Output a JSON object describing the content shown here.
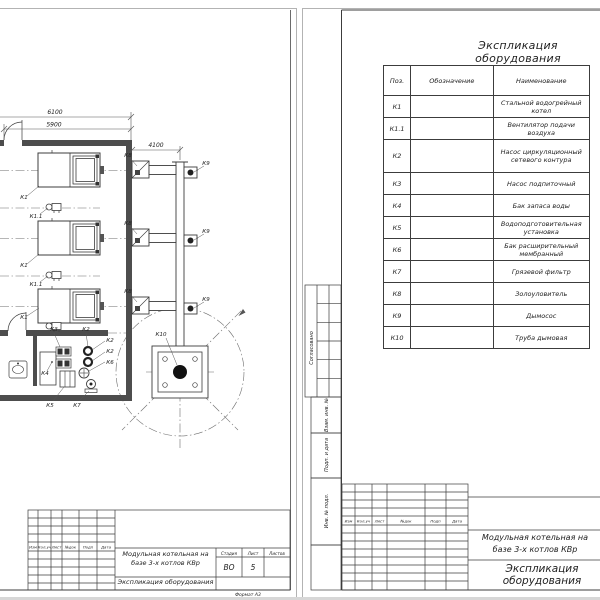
{
  "left_sheet": {
    "dimensions": {
      "top": "6100",
      "inner": "5900",
      "flue": "4100"
    },
    "callouts": {
      "k1": "К1",
      "k1_1": "К1.1",
      "k2": "К2",
      "k3": "К3",
      "k4": "К4",
      "k5": "К5",
      "k6": "К6",
      "k7": "К7",
      "k8": "К8",
      "k9": "К9",
      "k10": "К10"
    },
    "revision_header": [
      "Изм",
      "Кол.уч",
      "Лист",
      "№док",
      "Подп",
      "Дата"
    ],
    "title_block": {
      "project": "Модульная котельная на базе 3-х котлов КВр",
      "document": "Экспликация оборудования",
      "stage_label": "Стадия",
      "sheet_label": "Лист",
      "sheets_label": "Листов",
      "stage": "ВО",
      "sheet_no": "5",
      "format": "Формат А3"
    }
  },
  "right_sheet": {
    "table_title": "Экспликация оборудования",
    "equipment_table": {
      "headers": [
        "Поз.",
        "Обозначение",
        "Наименование"
      ],
      "rows": [
        {
          "pos": "К1",
          "designation": "",
          "name": "Стальной водогрейный котел"
        },
        {
          "pos": "К1.1",
          "designation": "",
          "name": "Вентилятор подачи воздуха"
        },
        {
          "pos": "К2",
          "designation": "",
          "name": "Насос циркуляционный сетевого контура"
        },
        {
          "pos": "К3",
          "designation": "",
          "name": "Насос подпиточный"
        },
        {
          "pos": "К4",
          "designation": "",
          "name": "Бак запаса воды"
        },
        {
          "pos": "К5",
          "designation": "",
          "name": "Водоподготовительная установка"
        },
        {
          "pos": "К6",
          "designation": "",
          "name": "Бак расширительный мембранный"
        },
        {
          "pos": "К7",
          "designation": "",
          "name": "Грязевой фильтр"
        },
        {
          "pos": "К8",
          "designation": "",
          "name": "Золоуловитель"
        },
        {
          "pos": "К9",
          "designation": "",
          "name": "Дымосос"
        },
        {
          "pos": "К10",
          "designation": "",
          "name": "Труба дымовая"
        }
      ]
    },
    "margin_labels": {
      "approved": "Согласовано",
      "replacement": "Взам. инв. №",
      "sign_date": "Подп. и дата",
      "inventory": "Инв. № подл."
    },
    "revision_header": [
      "Изм",
      "Кол.уч",
      "Лист",
      "№док",
      "Подп",
      "Дата"
    ],
    "title_block": {
      "project": "Модульная котельная на базе 3-х котлов КВр",
      "document": "Экспликация оборудования"
    }
  },
  "colors": {
    "line": "#3c3c3c",
    "wall": "#4d4d4d",
    "centerline": "#6e6e6e",
    "sheet_edge": "#b3b3b3"
  }
}
